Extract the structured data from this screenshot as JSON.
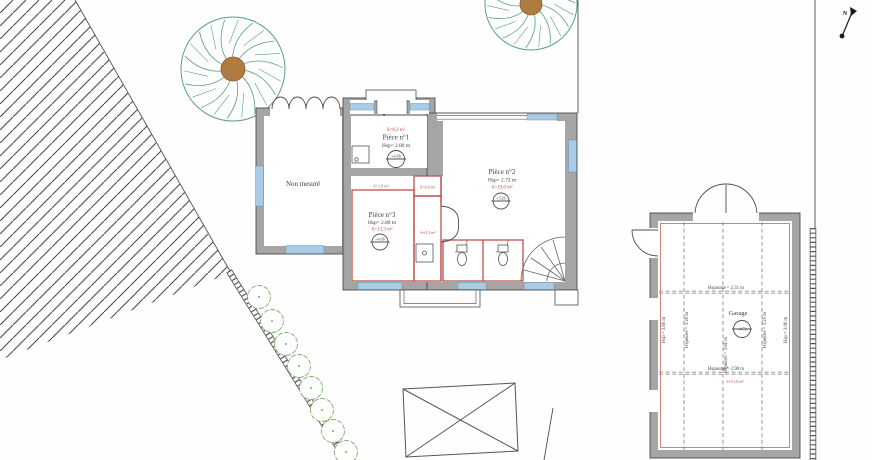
{
  "site": {
    "north_label": "N",
    "annex_label": "Non mesuré"
  },
  "rooms": [
    {
      "name": "Pièce n°1",
      "height": "Hsp= 2.80 m",
      "area": "S=8,2 m²",
      "level": "+4.68"
    },
    {
      "name": "Pièce n°2",
      "height": "Hsp= 2.72 m",
      "area": "S=19,6 m²",
      "level": "+5.26"
    },
    {
      "name": "Pièce n°3",
      "height": "Hsp= 2.80 m",
      "area": "S=13,3 m²",
      "level": "+4.68"
    }
  ],
  "annotations": {
    "hall_area": "S=1,8 m²",
    "closet_area": "S=0,8 m²",
    "corridor_area": "S=3,3 m²"
  },
  "garage": {
    "name": "Garage",
    "level": "+4.72",
    "area": "S=51,8 m²",
    "beam_top": "Hspoutre = 2.31 m",
    "beam_bottom": "Hspoutre = 2.98 m",
    "left_wall_height": "Hsp = 3.86 m",
    "beam_v1": "Hspoutre = 3.26 m",
    "beam_v2": "Hspoutre = 3.81 m",
    "beam_v3": "Hspoutre = 3.25 m",
    "right_wall_height": "Hsp = 3.96 m"
  },
  "colors": {
    "wall": "#a5a5a5",
    "wall_edge": "#4c4c4c",
    "window": "#a9cbe5",
    "partition_red": "#c0504d",
    "tree_green": "#58a17e",
    "bush_green": "#7ab266",
    "trunk_brown": "#b07b40",
    "hatch": "#4d4d4d"
  }
}
